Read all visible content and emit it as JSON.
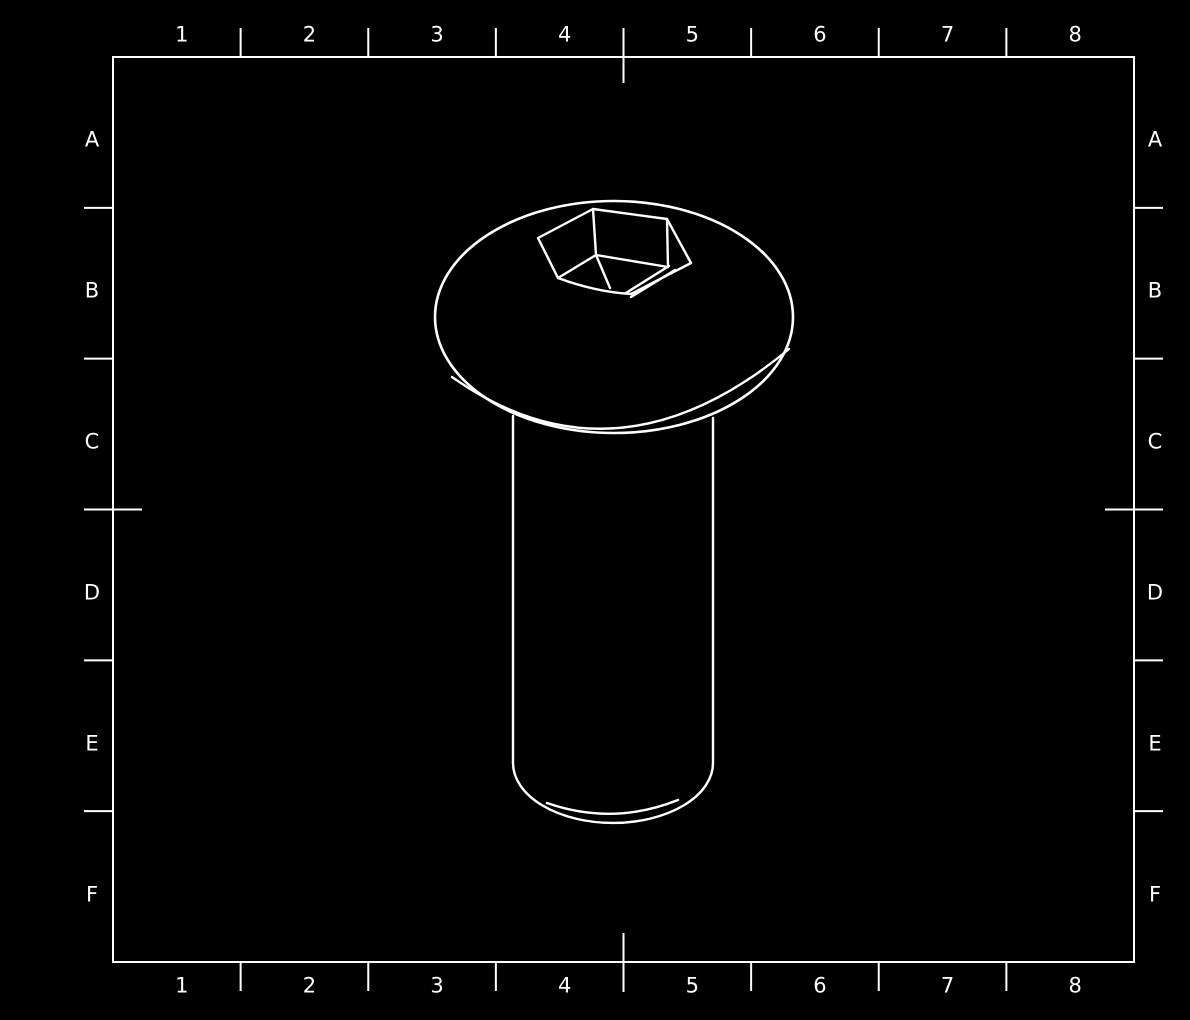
{
  "sheet": {
    "background_color": "#000000",
    "line_color": "#ffffff",
    "grid": {
      "columns": [
        "1",
        "2",
        "3",
        "4",
        "5",
        "6",
        "7",
        "8"
      ],
      "rows": [
        "A",
        "B",
        "C",
        "D",
        "E",
        "F"
      ]
    }
  }
}
